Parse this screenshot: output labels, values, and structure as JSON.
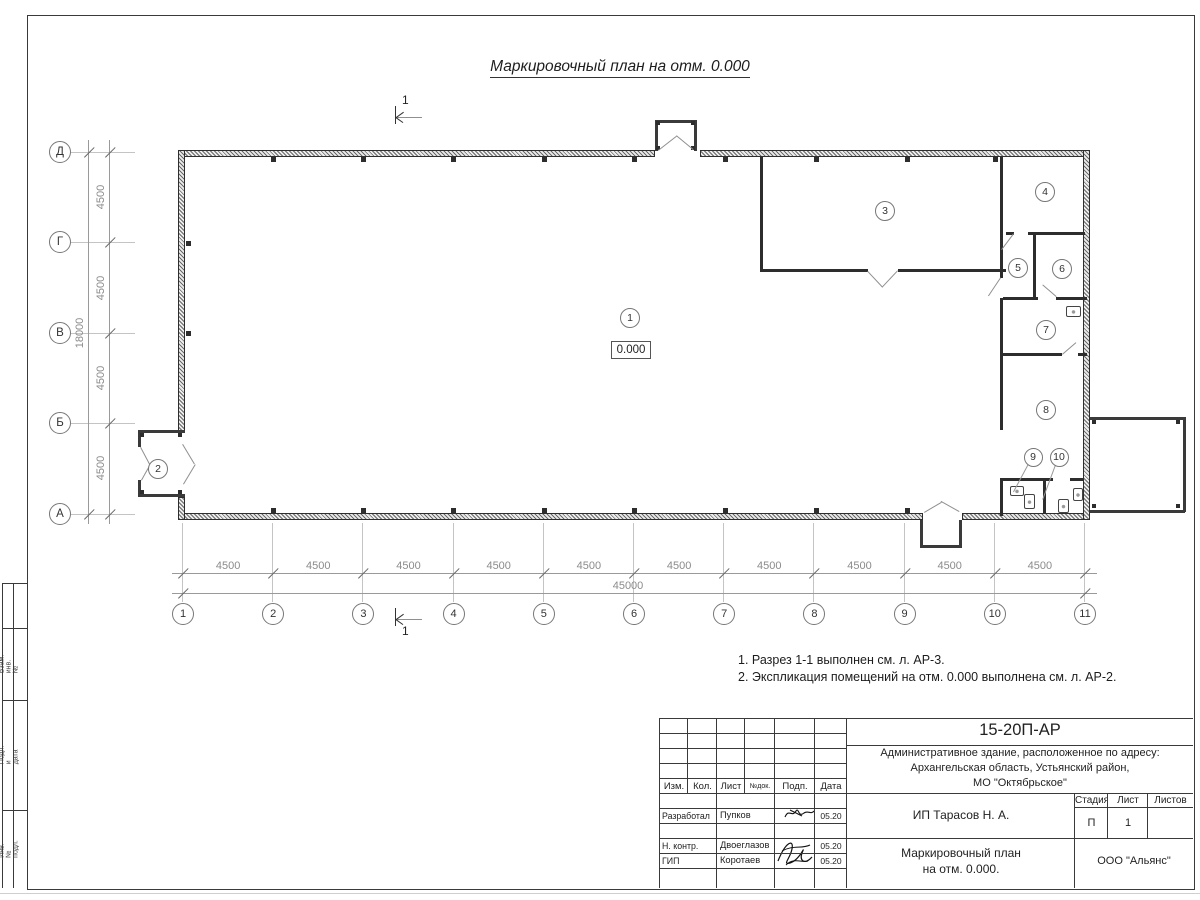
{
  "sheet": {
    "title": "Маркировочный план на отм. 0.000",
    "notes": [
      "1. Разрез 1-1 выполнен см. л. АР-3.",
      "2. Экспликация помещений на отм. 0.000 выполнена см. л. АР-2."
    ]
  },
  "plan": {
    "elevation_mark": "0.000",
    "section_mark": "1",
    "rooms": [
      "1",
      "2",
      "3",
      "4",
      "5",
      "6",
      "7",
      "8",
      "9",
      "10"
    ],
    "axes": {
      "columns": [
        "1",
        "2",
        "3",
        "4",
        "5",
        "6",
        "7",
        "8",
        "9",
        "10",
        "11"
      ],
      "column_spacings": [
        "4500",
        "4500",
        "4500",
        "4500",
        "4500",
        "4500",
        "4500",
        "4500",
        "4500",
        "4500"
      ],
      "columns_total": "45000",
      "rows": [
        "Д",
        "Г",
        "В",
        "Б",
        "А"
      ],
      "row_spacings": [
        "4500",
        "4500",
        "4500",
        "4500"
      ],
      "rows_total": "18000"
    }
  },
  "margin_labels": [
    "Взам. инв. №",
    "Подп. и дата",
    "Инв. № подл."
  ],
  "titleblock": {
    "doc_number": "15-20П-АР",
    "project_lines": [
      "Административное здание, расположенное по адресу:",
      "Архангельская область, Устьянский район,",
      "МО \"Октябрьское\""
    ],
    "header_cols": [
      "Изм.",
      "Кол.",
      "Лист",
      "№док.",
      "Подп.",
      "Дата"
    ],
    "roles": [
      {
        "role": "Разработал",
        "name": "Пупков",
        "date": "05.20"
      },
      {
        "role": "Н. контр.",
        "name": "Двоеглазов",
        "date": "05.20"
      },
      {
        "role": "ГИП",
        "name": "Коротаев",
        "date": "05.20"
      }
    ],
    "client": "ИП Тарасов Н. А.",
    "stage_label": "Стадия",
    "sheet_label": "Лист",
    "sheets_label": "Листов",
    "stage": "П",
    "sheet_no": "1",
    "sheets_total": "",
    "drawing_title_lines": [
      "Маркировочный план",
      "на отм. 0.000."
    ],
    "company": "ООО \"Альянс\""
  }
}
